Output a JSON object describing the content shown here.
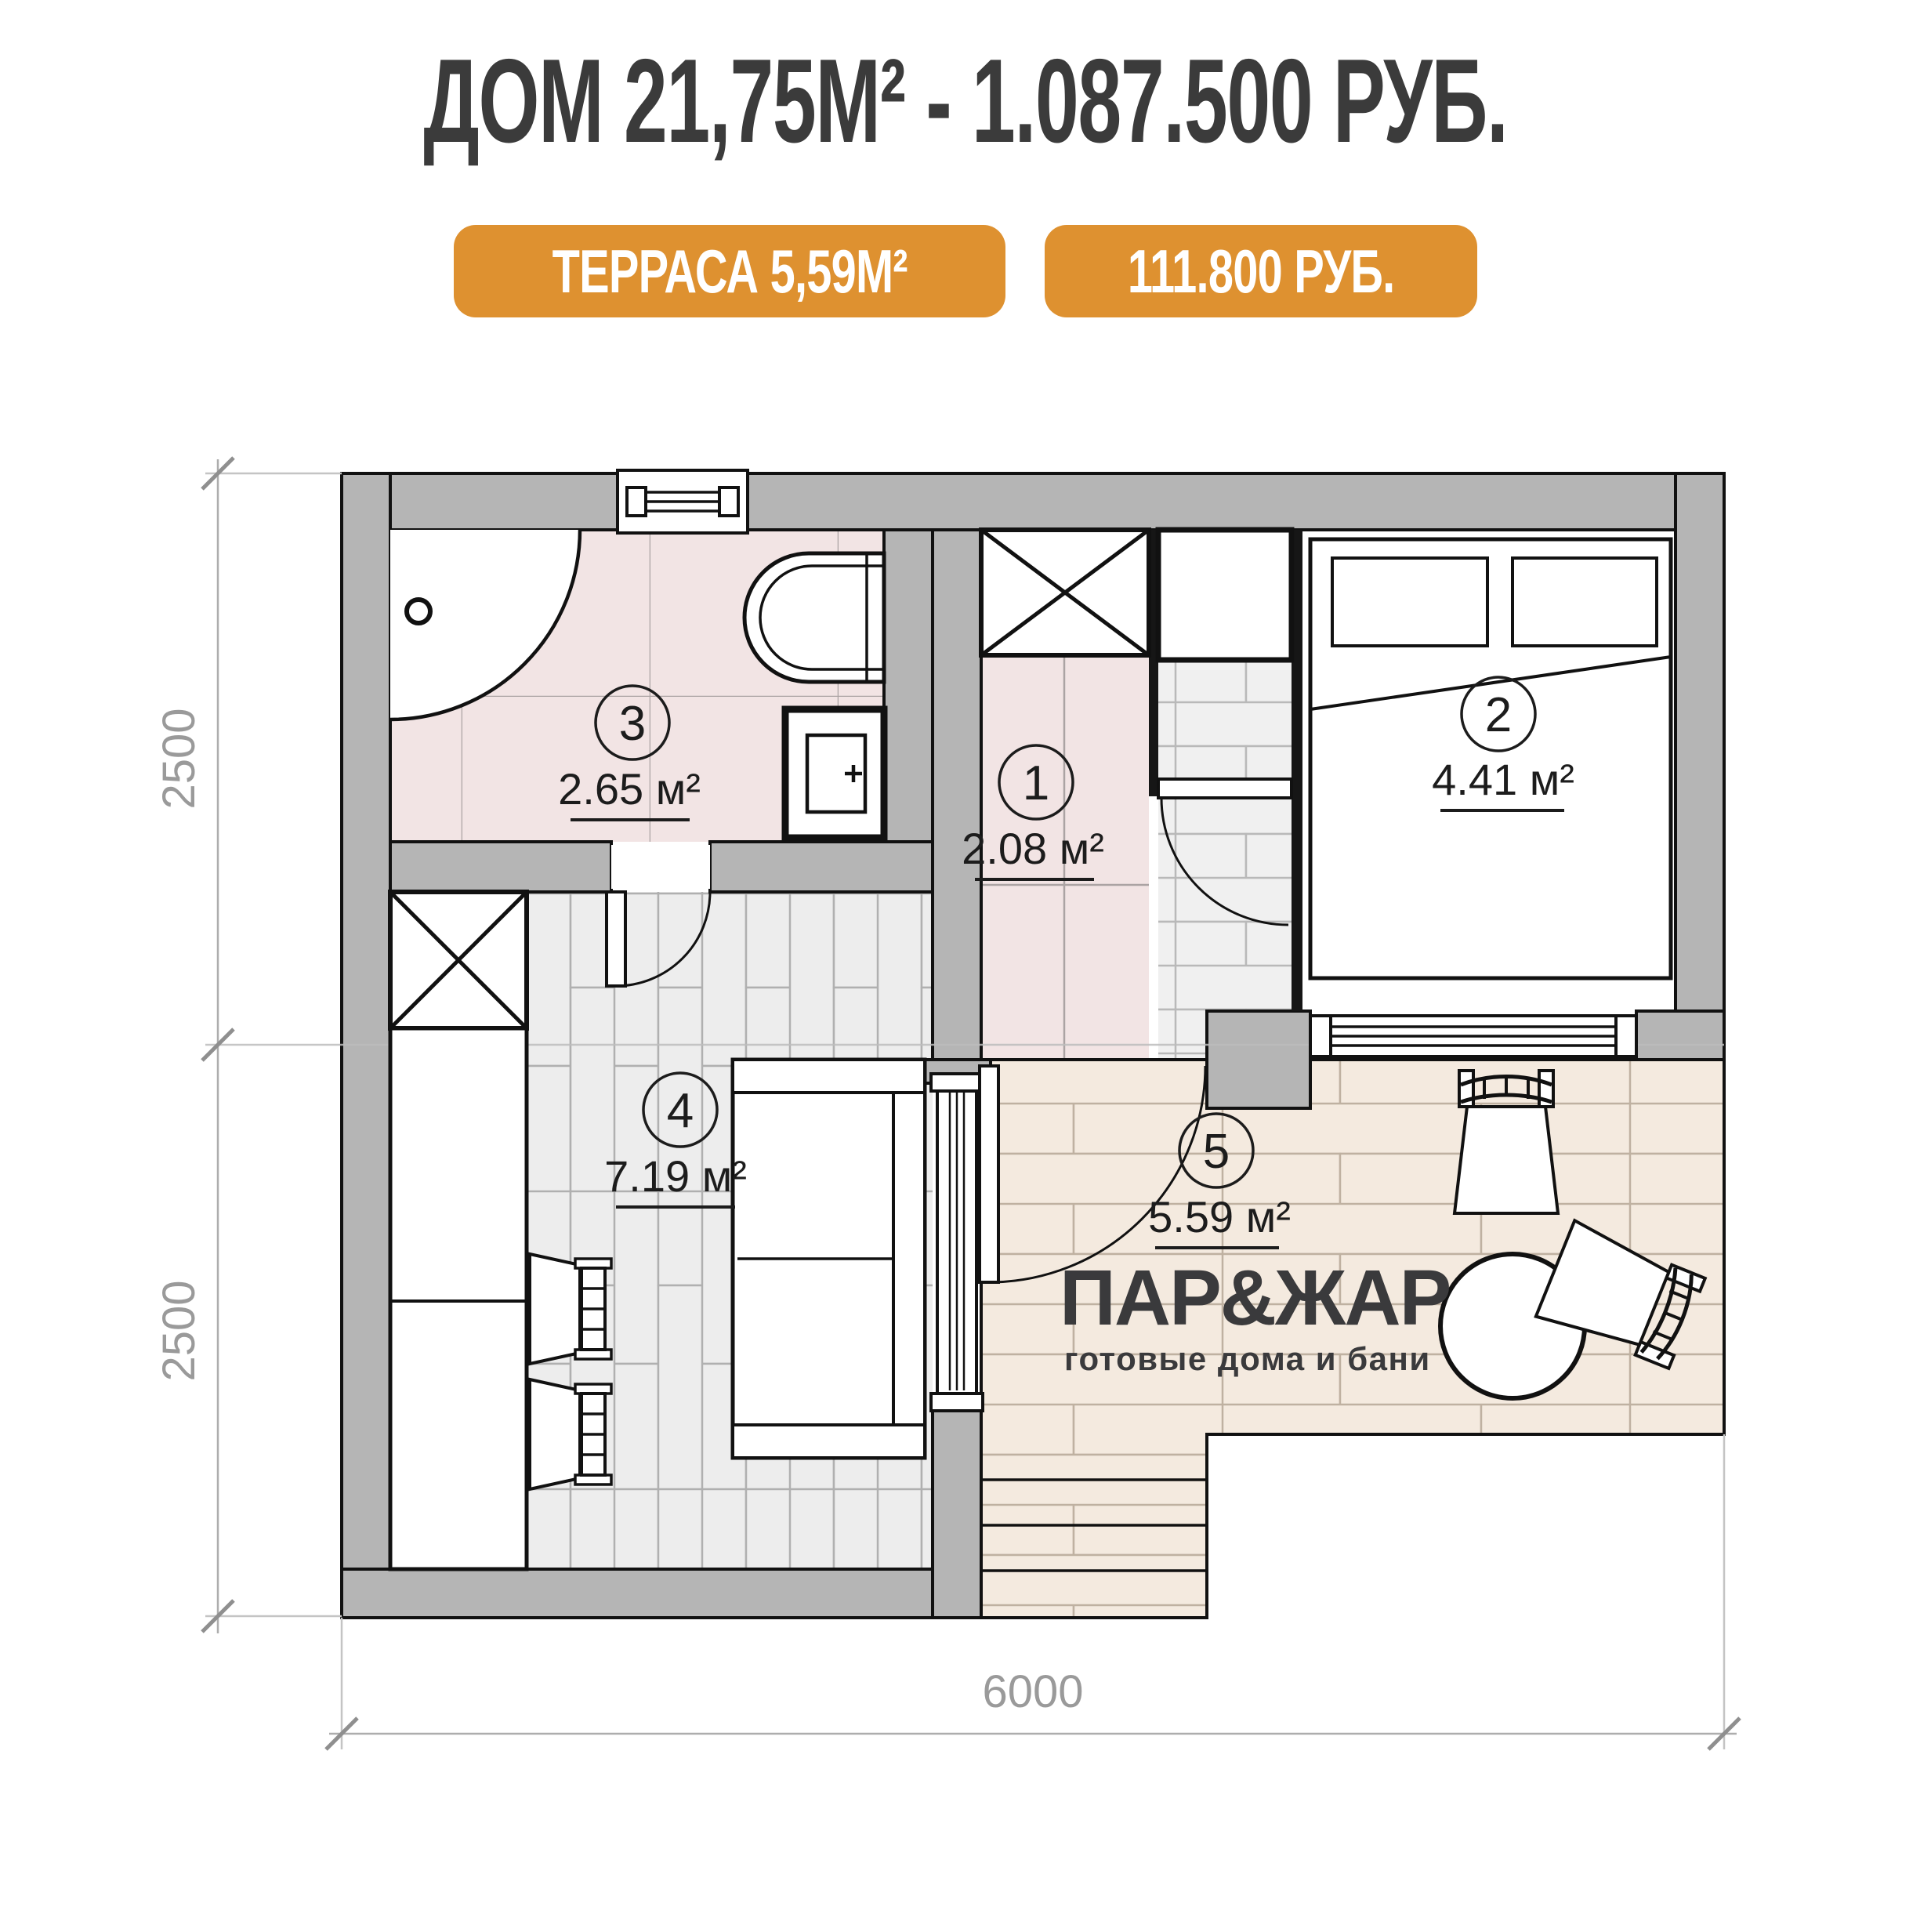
{
  "header": {
    "title": "ДОМ 21,75М² - 1.087.500 РУБ.",
    "title_color": "#3b3b3b",
    "accent_color": "#de9130",
    "badges": [
      {
        "label": "ТЕРРАСА 5,59М²"
      },
      {
        "label": "111.800 РУБ."
      }
    ]
  },
  "plan": {
    "rooms": [
      {
        "num": "1",
        "area": "2.08 м²",
        "name": "hall"
      },
      {
        "num": "2",
        "area": "4.41 м²",
        "name": "bedroom"
      },
      {
        "num": "3",
        "area": "2.65 м²",
        "name": "bathroom"
      },
      {
        "num": "4",
        "area": "7.19 м²",
        "name": "living-kitchen"
      },
      {
        "num": "5",
        "area": "5.59 м²",
        "name": "terrace"
      }
    ],
    "dimensions": {
      "left_top": "2500",
      "left_bottom": "2500",
      "bottom": "6000"
    },
    "logo": {
      "brand": "ПАР&ЖАР",
      "tagline": "готовые дома и бани"
    },
    "colors": {
      "wall": "#b5b5b5",
      "bath_floor": "#f2e4e4",
      "wood_floor": "#ededed",
      "terrace_floor": "#f4eadf"
    }
  }
}
